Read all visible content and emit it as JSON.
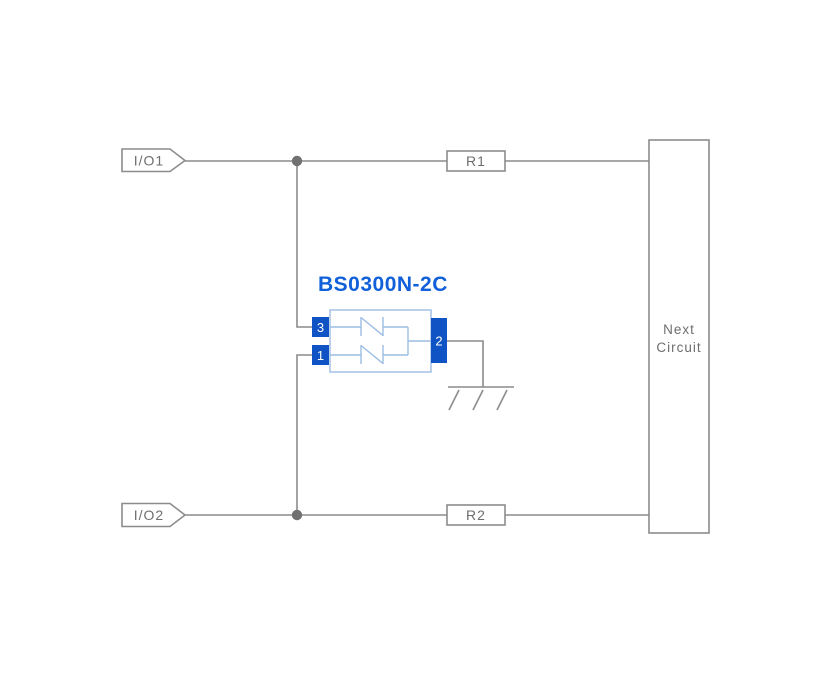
{
  "diagram": {
    "title": "BS0300N-2C",
    "connectors": {
      "io1": "I/O1",
      "io2": "I/O2"
    },
    "resistors": {
      "r1": "R1",
      "r2": "R2"
    },
    "next_circuit": {
      "line1": "Next",
      "line2": "Circuit"
    },
    "component_pins": {
      "pin3": "3",
      "pin1": "1",
      "pin2": "2"
    },
    "colors": {
      "wire_gray": "#8c8c8c",
      "label_gray": "#6e6e6e",
      "junction_gray": "#717171",
      "accent_blue": "#1160d9",
      "pin_blue": "#1053c4",
      "component_outline_blue": "#a3c1e6",
      "background": "#ffffff"
    }
  }
}
